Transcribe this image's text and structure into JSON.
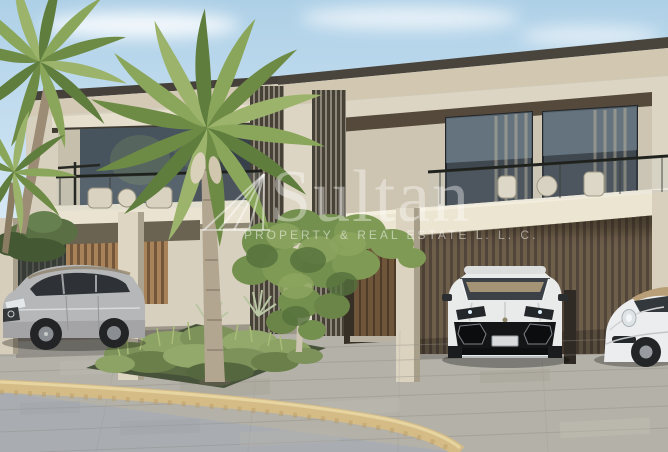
{
  "watermark": {
    "title": "Sultan",
    "tagline": "PROPERTY & REAL ESTATE L. L. C.",
    "logo": "sail-fan-lines-logo",
    "color": "#ffffff"
  },
  "scene": {
    "description": "3D exterior rendering of a modern beige two-storey townhouse with glass balconies, slatted carports, palm trees and three parked cars",
    "vehicles": [
      "silver SUV",
      "white SUV",
      "white sports car with tan roof"
    ],
    "vegetation": [
      "palm trees",
      "ornamental grass bed",
      "leafy tree",
      "hedge"
    ],
    "palette": {
      "sky": "#c6dff0",
      "wall": "#d9d2c0",
      "roof_trim": "#46423a",
      "carport_wood": "#a8835a",
      "garage_wood": "#6e5f4b",
      "window_glass": "#3b434c",
      "driveway": "#b4b1a8",
      "road": "#a9adb2",
      "curb": "#d5bc87",
      "foliage": "#7f9c52",
      "car_silver": "#b6b7b9",
      "car_white": "#e9eaea"
    }
  }
}
